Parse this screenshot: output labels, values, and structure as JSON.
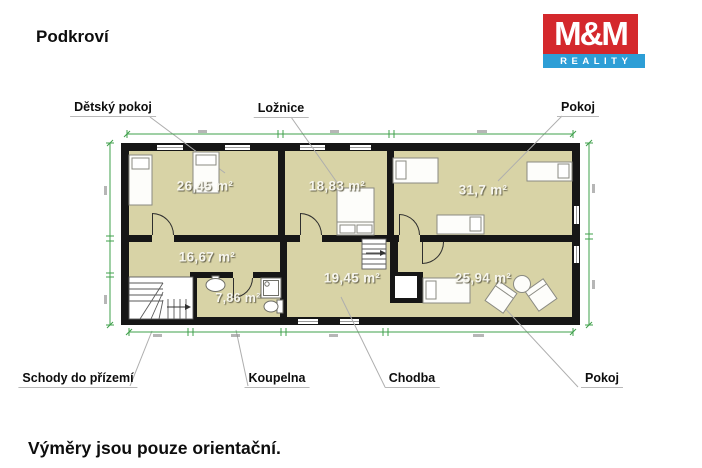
{
  "page": {
    "title": "Podkroví",
    "footer": "Výměry jsou pouze orientační."
  },
  "logo": {
    "mm": "M&M",
    "reality": "REALITY",
    "red": "#d4282c",
    "blue": "#2d9ed6"
  },
  "labels": {
    "detsky_pokoj": "Dětský pokoj",
    "loznice": "Ložnice",
    "pokoj_top": "Pokoj",
    "schody": "Schody do přízemí",
    "koupelna": "Koupelna",
    "chodba": "Chodba",
    "pokoj_bottom": "Pokoj"
  },
  "areas": {
    "detsky_pokoj": "26,45 m²",
    "loznice": "18,83 m²",
    "pokoj_top": "31,7 m²",
    "mistnost": "16,67 m²",
    "koupelna": "7,86 m²",
    "chodba": "19,45 m²",
    "pokoj_bottom": "25,94 m²"
  },
  "colors": {
    "floor": "#d8d3a6",
    "wall": "#161616",
    "dimension_green": "#3fa04b"
  }
}
